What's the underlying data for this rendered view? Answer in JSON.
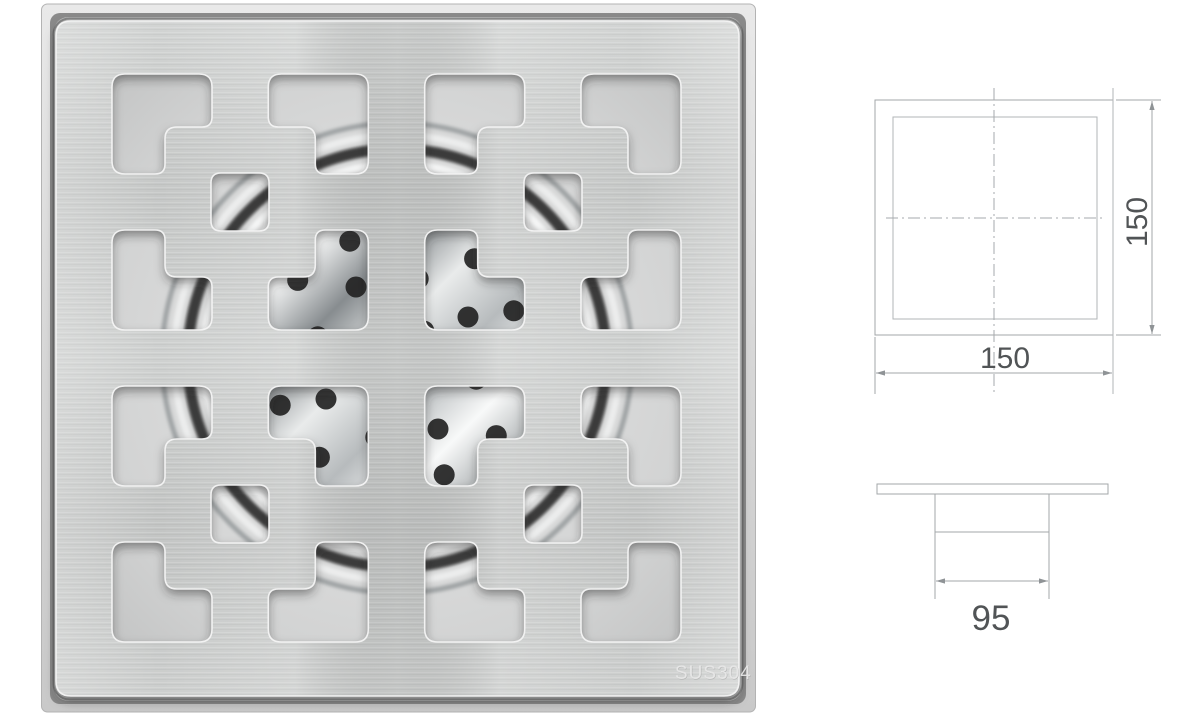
{
  "page": {
    "background": "#ffffff",
    "description": "Stainless steel square shower floor drain grate photo with dimension drawings"
  },
  "product_photo": {
    "type": "square-shower-drain-grate",
    "marking": "SUS304",
    "colors": {
      "plate": "#c8cac9",
      "plate_light": "#d6d8d7",
      "frame": "#d9d9d9",
      "frame_edge": "#b3b3b3",
      "seam": "#6e6e6e",
      "shadow": "#2a2a2a",
      "under_base_center": "#e9e9e9",
      "under_base_edge": "#b7b8b8",
      "gasket_ring": "#3a3a3a",
      "ring_bright": "#f5f6f6",
      "ring_light": "#eceded",
      "ring_mid": "#9fa3a4",
      "strainer_rim": "#5d5e60",
      "perforation": "#232323",
      "marking_color": "#ebebeb",
      "bevel_highlight": "#f4f4f4"
    }
  },
  "dimension_drawings": {
    "line_color": "#a3a7aa",
    "inner_line_color": "#b2b5b7",
    "arrow_color": "#8f9396",
    "text_color": "#515456",
    "top_view": {
      "width": "150",
      "height": "150"
    },
    "side_view": {
      "width": "95"
    }
  }
}
